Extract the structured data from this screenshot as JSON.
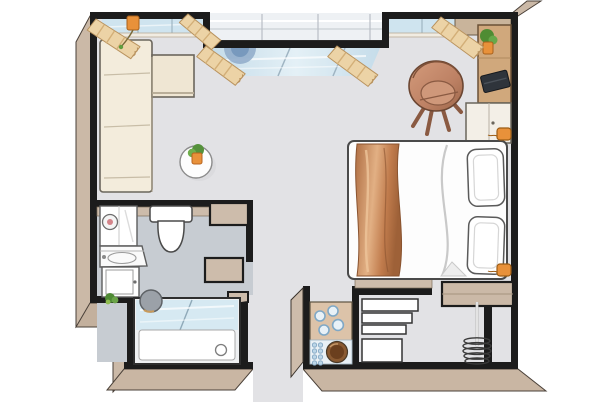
{
  "document": {
    "type": "floor-plan",
    "style": "top-down 3d illustrated studio apartment plan",
    "background": "#ffffff"
  },
  "palette": {
    "wall_outline": "#1c1c1c",
    "wall_face_beige": "#cbb9a7",
    "floor_main": "#e2e2e5",
    "floor_bathroom": "#c7ccd2",
    "window_glass": "#cfe4ef",
    "curtain_tan": "#ecd3a6",
    "copper_wood": "#c27c4e",
    "accent_orange": "#e8913a",
    "plant_green": "#5f9e3e",
    "appliance_white": "#ffffff",
    "hob_blue": "#9fc0d8",
    "sink_bronze": "#8a5a32",
    "stool_gray": "#9ba1a8"
  },
  "rooms": [
    {
      "id": "main-room",
      "label": "living / sleeping room",
      "floor_color": "#e2e2e5",
      "furniture": [
        "corner-sofa",
        "round-side-table",
        "potted-plant",
        "tub-armchair",
        "wall-desk",
        "laptop",
        "desk-plant",
        "tall-cabinet",
        "double-bed",
        "copper-throw-blanket",
        "pillow x2",
        "wall-lamp x2",
        "window-sill-vase",
        "bay-window-stool"
      ]
    },
    {
      "id": "bathroom",
      "label": "bathroom",
      "floor_color": "#c7ccd2",
      "furniture": [
        "washing-machine",
        "washbasin",
        "base-cabinet",
        "floor-plant",
        "wall-hung-toilet",
        "round-stool",
        "bathtub",
        "glass-shower-screen"
      ]
    },
    {
      "id": "kitchenette",
      "label": "kitchen niche",
      "floor_color": "#e2e2e5",
      "furniture": [
        "counter",
        "four-burner-hob",
        "round-sink",
        "dish-drainer"
      ]
    },
    {
      "id": "entry-hall",
      "label": "entry / wardrobe area",
      "floor_color": "#e2e2e5",
      "furniture": [
        "stepped-shelf-unit",
        "storage-box",
        "wardrobe-top-shelf",
        "clothes-rail-with-hangers"
      ]
    }
  ],
  "windows": [
    {
      "id": "window-top-left",
      "curtains": 2
    },
    {
      "id": "bay-window-center",
      "curtains": 2
    },
    {
      "id": "window-top-right",
      "curtains": 1
    }
  ]
}
